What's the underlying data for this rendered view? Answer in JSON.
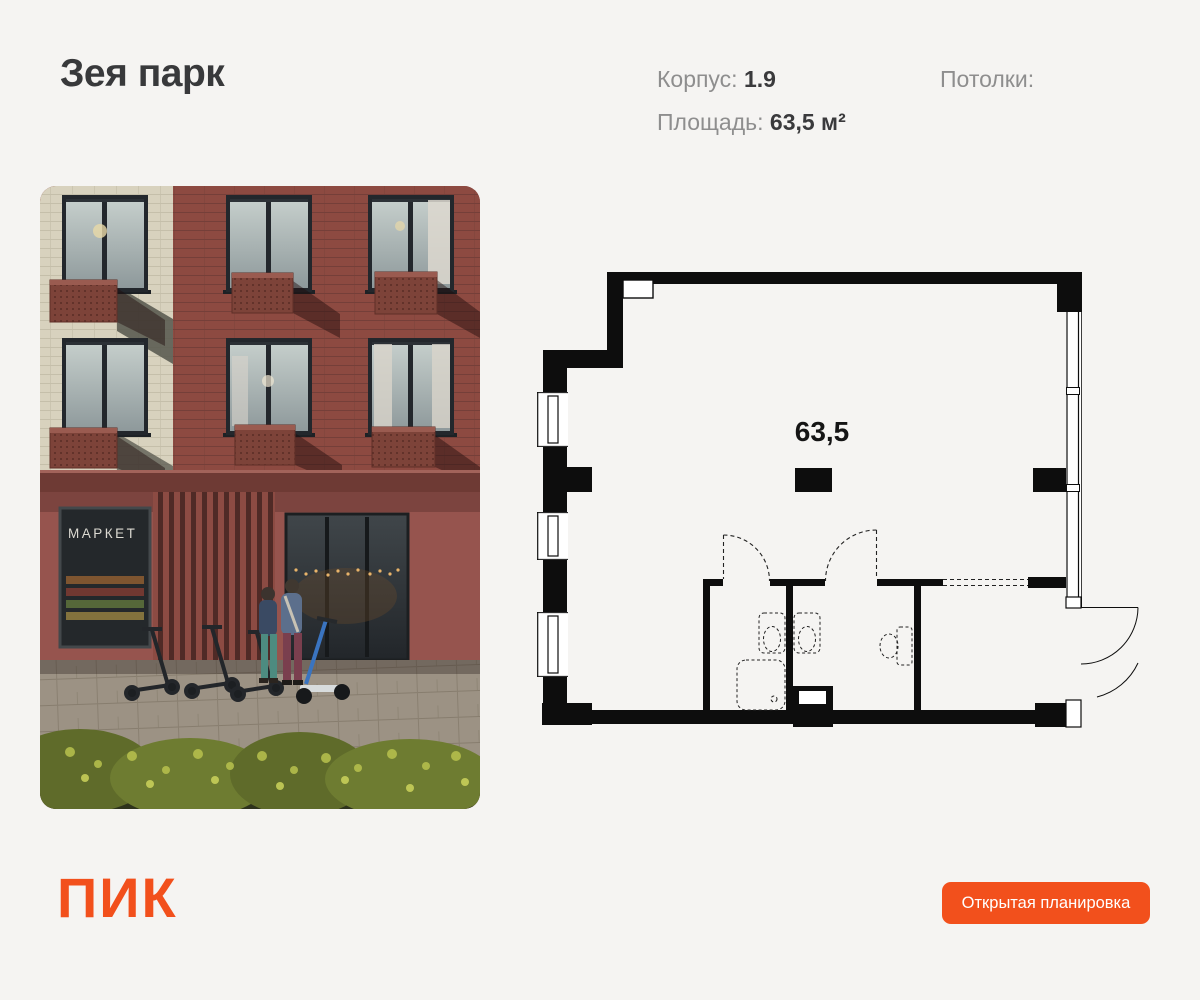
{
  "header": {
    "title": "Зея парк",
    "specs": [
      {
        "label": "Корпус:",
        "value": "1.9"
      },
      {
        "label": "Площадь:",
        "value": "63,5 м²"
      },
      {
        "label": "Потолки:",
        "value": ""
      }
    ]
  },
  "photo": {
    "market_sign": "МАРКЕТ"
  },
  "floor_plan": {
    "area_label": "63,5"
  },
  "footer": {
    "logo_text": "ПИК",
    "button_label": "Открытая планировка"
  },
  "colors": {
    "accent": "#f2501c",
    "page_bg": "#f5f4f2",
    "plan_line": "#0d0d0d"
  }
}
